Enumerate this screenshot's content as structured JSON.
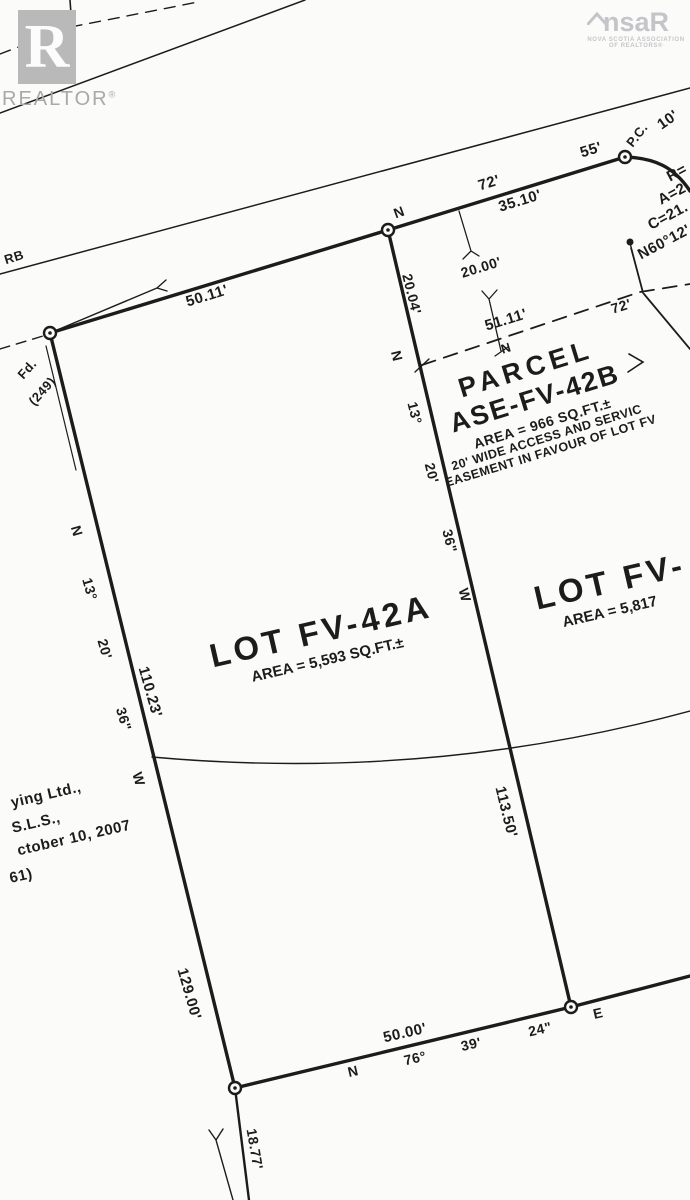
{
  "page": {
    "background": "#fbfbfa",
    "ink_color": "#1c1c1c",
    "logo_gray": "#b9b9b9"
  },
  "branding": {
    "realtor_logo_letter": "R",
    "realtor_wordmark": "REALTOR",
    "realtor_reg": "®",
    "nsar_left": "ns",
    "nsar_right": "aR",
    "nsar_sub1": "NOVA SCOTIA ASSOCIATION",
    "nsar_sub2": "OF REALTORS®"
  },
  "lots": {
    "lot_a_title": "LOT FV-42A",
    "lot_a_area": "AREA = 5,593 SQ.FT.±",
    "lot_b_title": "LOT FV-",
    "lot_b_area": "AREA = 5,817",
    "parcel_title_1": "PARCEL",
    "parcel_title_2": "ASE-FV-42B",
    "parcel_area": "AREA = 966 SQ.FT.±",
    "parcel_note_1": "20' WIDE ACCESS AND SERVIC",
    "parcel_note_2": "EASEMENT IN FAVOUR OF LOT FV"
  },
  "labels": [
    {
      "name": "curb",
      "text": "RB",
      "x": 14,
      "y": 257,
      "r": -17,
      "s": 13
    },
    {
      "name": "dist-50-11",
      "text": "50.11'",
      "x": 207,
      "y": 296,
      "r": -17,
      "s": 15
    },
    {
      "name": "found-monument",
      "text": "Fd.",
      "x": 27,
      "y": 369,
      "r": -48,
      "s": 13
    },
    {
      "name": "found-monument-num",
      "text": "(249)",
      "x": 42,
      "y": 391,
      "r": -48,
      "s": 13
    },
    {
      "name": "bearing-n-top",
      "text": "N",
      "x": 399,
      "y": 212,
      "r": -20,
      "s": 14
    },
    {
      "name": "bearing-72-top",
      "text": "72'",
      "x": 489,
      "y": 183,
      "r": -17,
      "s": 15
    },
    {
      "name": "dist-35-10",
      "text": "35.10'",
      "x": 520,
      "y": 201,
      "r": -17,
      "s": 15
    },
    {
      "name": "dist-55",
      "text": "55'",
      "x": 591,
      "y": 150,
      "r": -17,
      "s": 15
    },
    {
      "name": "point-of-curvature",
      "text": "P.C.",
      "x": 637,
      "y": 135,
      "r": -52,
      "s": 13
    },
    {
      "name": "dist-10",
      "text": "10'",
      "x": 668,
      "y": 120,
      "r": -35,
      "s": 15
    },
    {
      "name": "curve-radius",
      "text": "R=",
      "x": 677,
      "y": 173,
      "r": -28,
      "s": 15
    },
    {
      "name": "curve-arc",
      "text": "A=2",
      "x": 672,
      "y": 194,
      "r": -28,
      "s": 15
    },
    {
      "name": "curve-chord",
      "text": "C=21.",
      "x": 668,
      "y": 216,
      "r": -28,
      "s": 15
    },
    {
      "name": "curve-bearing",
      "text": "N60°12'43",
      "x": 672,
      "y": 238,
      "r": -28,
      "s": 15
    },
    {
      "name": "dim-20-00",
      "text": "20.00'",
      "x": 481,
      "y": 267,
      "r": -17,
      "s": 14
    },
    {
      "name": "dist-20-04",
      "text": "20.04'",
      "x": 412,
      "y": 294,
      "r": 76,
      "s": 14
    },
    {
      "name": "bearing-n-mid",
      "text": "N",
      "x": 397,
      "y": 356,
      "r": 76,
      "s": 14
    },
    {
      "name": "bearing-13-mid",
      "text": "13°",
      "x": 415,
      "y": 413,
      "r": 76,
      "s": 14
    },
    {
      "name": "bearing-20-mid",
      "text": "20'",
      "x": 432,
      "y": 473,
      "r": 76,
      "s": 14
    },
    {
      "name": "bearing-36-mid",
      "text": "36\"",
      "x": 450,
      "y": 541,
      "r": 76,
      "s": 14
    },
    {
      "name": "bearing-w-mid",
      "text": "W",
      "x": 465,
      "y": 595,
      "r": 76,
      "s": 14
    },
    {
      "name": "dist-51-11",
      "text": "51.11'",
      "x": 506,
      "y": 320,
      "r": -17,
      "s": 15
    },
    {
      "name": "bearing-n-easement",
      "text": "N",
      "x": 506,
      "y": 348,
      "r": -17,
      "s": 13
    },
    {
      "name": "dist-72-easement",
      "text": "72'",
      "x": 621,
      "y": 306,
      "r": -17,
      "s": 14
    },
    {
      "name": "dist-113-50",
      "text": "113.50'",
      "x": 506,
      "y": 812,
      "r": 76,
      "s": 15
    },
    {
      "name": "bearing-n-left",
      "text": "N",
      "x": 77,
      "y": 531,
      "r": 74,
      "s": 14
    },
    {
      "name": "bearing-13-left",
      "text": "13°",
      "x": 90,
      "y": 589,
      "r": 74,
      "s": 14
    },
    {
      "name": "bearing-20-left",
      "text": "20'",
      "x": 105,
      "y": 649,
      "r": 74,
      "s": 14
    },
    {
      "name": "bearing-36-left",
      "text": "36\"",
      "x": 124,
      "y": 719,
      "r": 74,
      "s": 14
    },
    {
      "name": "bearing-w-left",
      "text": "W",
      "x": 139,
      "y": 779,
      "r": 74,
      "s": 14
    },
    {
      "name": "dist-110-23",
      "text": "110.23'",
      "x": 150,
      "y": 692,
      "r": 74,
      "s": 15
    },
    {
      "name": "dist-129-00",
      "text": "129.00'",
      "x": 189,
      "y": 994,
      "r": 74,
      "s": 15
    },
    {
      "name": "dist-18-77",
      "text": "18.77'",
      "x": 255,
      "y": 1149,
      "r": 80,
      "s": 14
    },
    {
      "name": "dist-50-00",
      "text": "50.00'",
      "x": 405,
      "y": 1033,
      "r": -13,
      "s": 15
    },
    {
      "name": "bearing-n-bottom",
      "text": "N",
      "x": 353,
      "y": 1071,
      "r": -13,
      "s": 14
    },
    {
      "name": "bearing-76-bottom",
      "text": "76°",
      "x": 415,
      "y": 1058,
      "r": -13,
      "s": 14
    },
    {
      "name": "bearing-39-bottom",
      "text": "39'",
      "x": 471,
      "y": 1044,
      "r": -13,
      "s": 14
    },
    {
      "name": "bearing-24-bottom",
      "text": "24\"",
      "x": 540,
      "y": 1029,
      "r": -13,
      "s": 14
    },
    {
      "name": "bearing-e-bottom",
      "text": "E",
      "x": 598,
      "y": 1013,
      "r": -13,
      "s": 14
    },
    {
      "name": "surveyor-note-1",
      "text": "ying Ltd.,",
      "x": 46,
      "y": 795,
      "r": -13,
      "s": 15
    },
    {
      "name": "surveyor-note-2",
      "text": "S.L.S.,",
      "x": 36,
      "y": 823,
      "r": -13,
      "s": 15
    },
    {
      "name": "surveyor-note-3",
      "text": "ctober 10, 2007",
      "x": 74,
      "y": 838,
      "r": -13,
      "s": 15
    },
    {
      "name": "surveyor-note-4",
      "text": "61)",
      "x": 21,
      "y": 876,
      "r": -13,
      "s": 15
    }
  ]
}
